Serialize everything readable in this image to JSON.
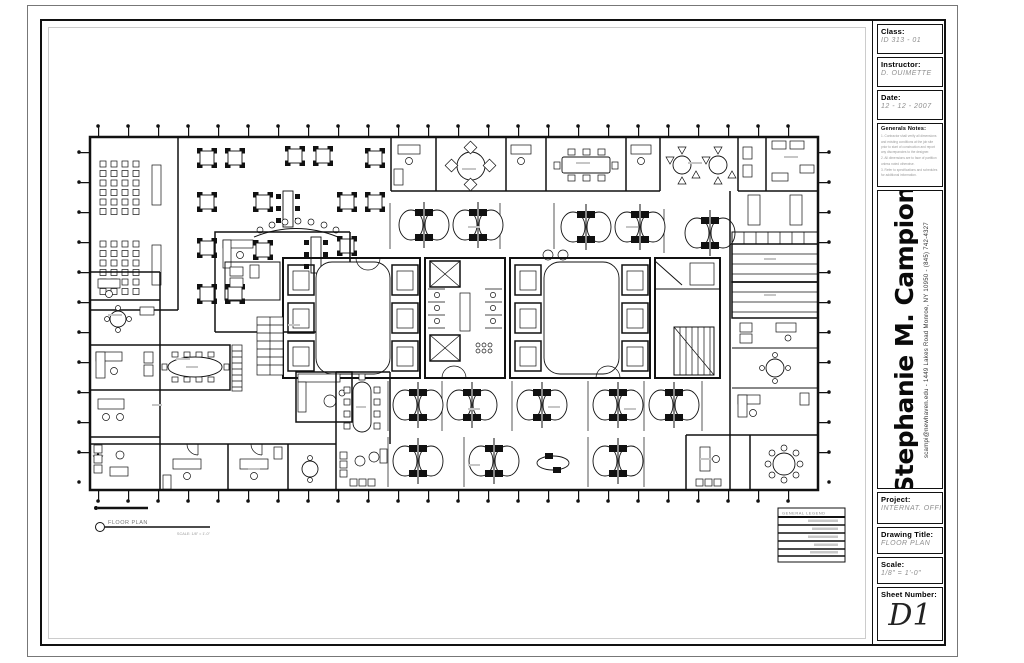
{
  "title_block": {
    "class_label": "Class:",
    "class_value": "ID 313 - 01",
    "instructor_label": "Instructor:",
    "instructor_value": "D. OUIMETTE",
    "date_label": "Date:",
    "date_value": "12 - 12 - 2007",
    "notes_label": "Generals Notes:",
    "notes_lines": [
      "1. Contractor shall verify all dimensions and existing conditions at the job site prior to start of construction and report any discrepancies to the designer.",
      "2. All dimensions are to face of partition unless noted otherwise.",
      "3. Refer to specifications and schedules for additional information."
    ],
    "designer_name": "Stephanie M. Campion",
    "designer_contact": "scampi@newhaven.edu  -  1449 Lakes Road    Monroe, NY 10950  -  (845) 742-4327",
    "project_label": "Project:",
    "project_value": "INTERNAT. OFFICE",
    "drawing_title_label": "Drawing Title:",
    "drawing_title_value": "FLOOR PLAN",
    "scale_label": "Scale:",
    "scale_value": "1/8\" = 1'-0\"",
    "sheet_label": "Sheet Number:",
    "sheet_value": "D1"
  },
  "plan": {
    "callout_title": "FLOOR PLAN",
    "callout_scale": "SCALE: 1/8\" = 1'-0\"",
    "legend_title": "GENERAL LEGEND"
  }
}
